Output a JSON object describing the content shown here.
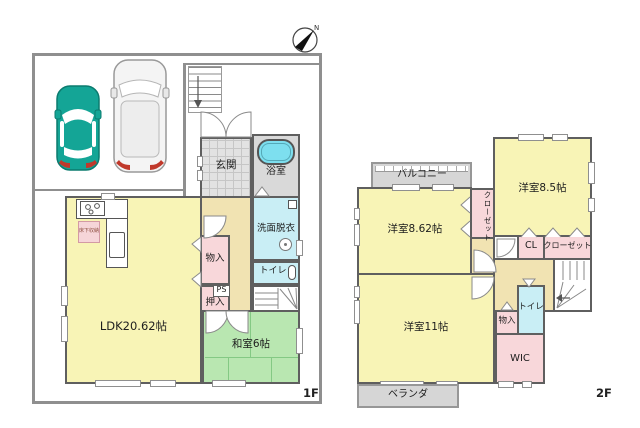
{
  "compass": {
    "north_label": "N"
  },
  "floor1": {
    "floor_label": "1F",
    "rooms": {
      "genkan": "玄関",
      "bathroom": "浴室",
      "washroom": "洗面脱衣",
      "toilet": "トイレ",
      "storage": "物入",
      "pipe_space": "PS",
      "oshiire": "押入",
      "ldk": "LDK20.62帖",
      "washitsu": "和室6帖",
      "underfloor_storage": "床下収納"
    }
  },
  "floor2": {
    "floor_label": "2F",
    "rooms": {
      "balcony": "バルコニー",
      "bedroom_862": "洋室8.62帖",
      "closet_side": "クローゼット",
      "bedroom_85": "洋室8.5帖",
      "cl": "CL",
      "closet": "クローゼット",
      "bedroom_11": "洋室11帖",
      "storage": "物入",
      "toilet": "トイレ",
      "wic": "WIC",
      "veranda": "ベランダ"
    }
  },
  "colors": {
    "room_yellow": "#f8f4b6",
    "tatami_green": "#b9e7b1",
    "closet_pink": "#f8d7da",
    "wet_area_cyan": "#c9eef5",
    "bathtub_cyan": "#7ddfef",
    "corridor_tan": "#f1e3b2",
    "entrance_tile_gray": "#e2e2e2",
    "balcony_gray": "#d6d6d6",
    "wall_gray": "#5f5f5f",
    "site_boundary_gray": "#8f8f8f",
    "car_teal": "#14a596",
    "taillight_red": "#c0392b"
  }
}
